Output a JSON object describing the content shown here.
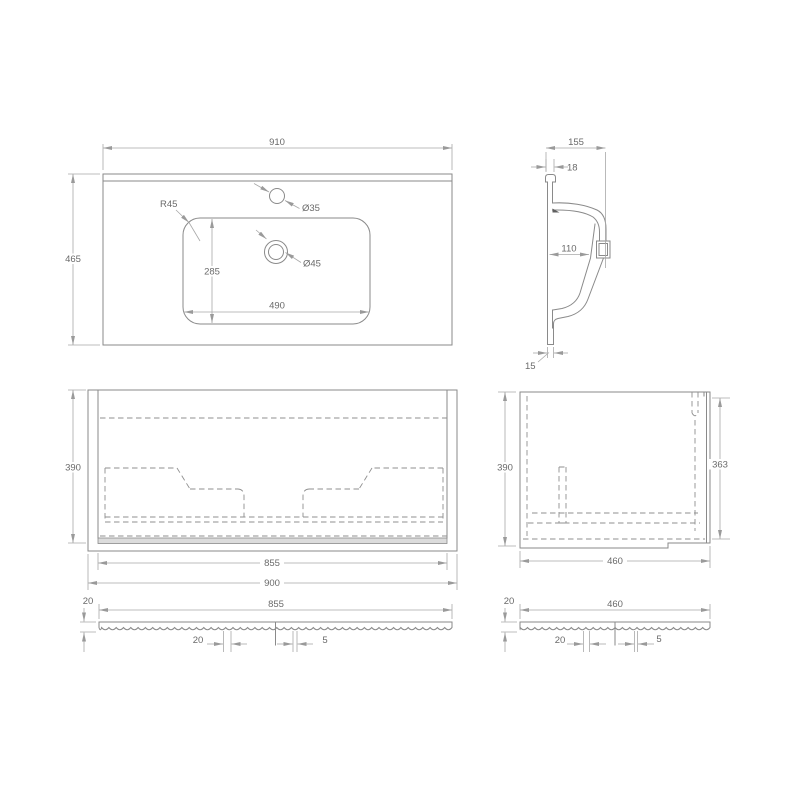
{
  "drawing_type": "bathroom-vanity-technical-drawing",
  "colors": {
    "object_line": "#8a8a8a",
    "dimension_line": "#a8a8a8",
    "text": "#6a6a6a",
    "plinth_fill": "#dcdcdc",
    "background": "#ffffff"
  },
  "views": {
    "basin_plan": {
      "overall_width": "910",
      "overall_depth": "465",
      "bowl_corner_radius": "R45",
      "faucet_hole": "Ø35",
      "drain_hole": "Ø45",
      "bowl_depth": "285",
      "bowl_width": "490"
    },
    "basin_section": {
      "overall_depth": "155",
      "upstand_thickness": "18",
      "bowl_inner_depth": "110",
      "bottom_lip": "15"
    },
    "cabinet_front": {
      "height": "390",
      "inner_width": "855",
      "overall_width": "900"
    },
    "cabinet_side": {
      "height": "390",
      "inner_height": "363",
      "depth": "460"
    },
    "front_panel": {
      "thickness": "20",
      "width": "855",
      "flute_pitch": "20",
      "flute_gap": "5"
    },
    "side_panel": {
      "thickness": "20",
      "width": "460",
      "flute_pitch": "20",
      "flute_gap": "5"
    }
  }
}
